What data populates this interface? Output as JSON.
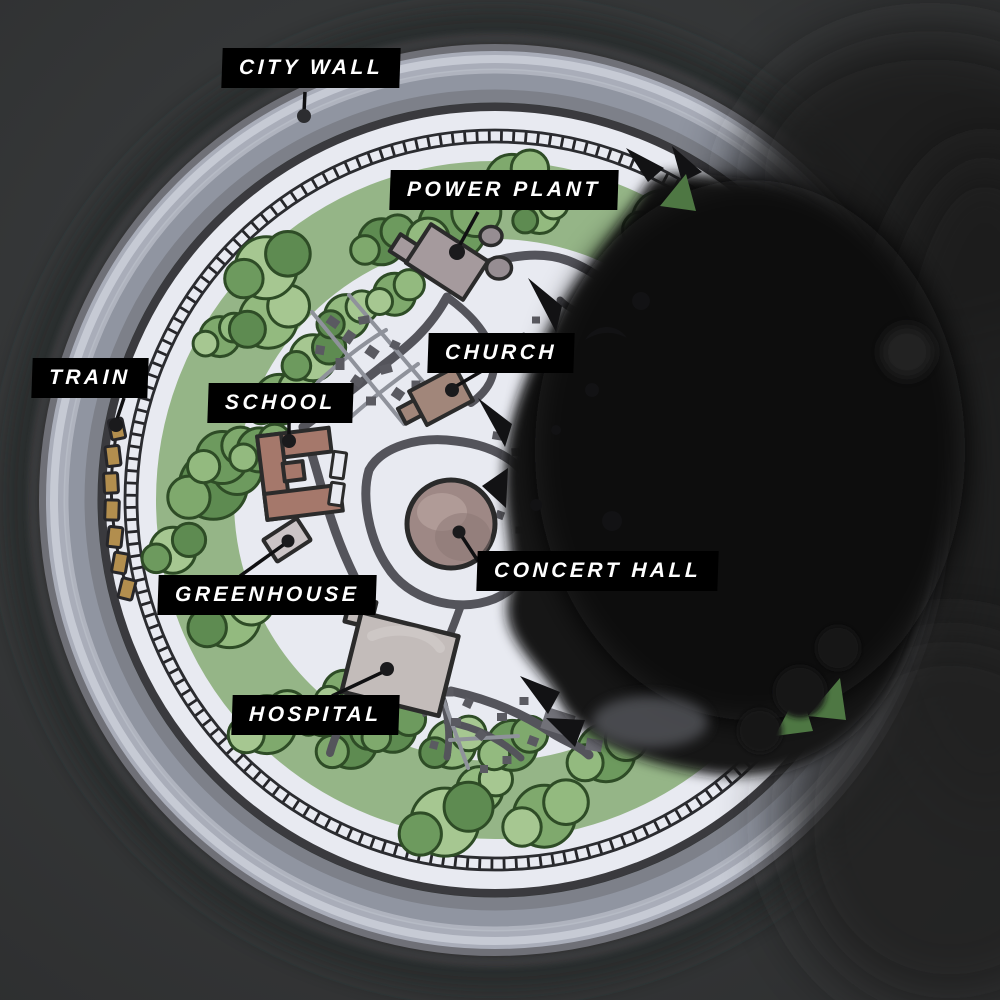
{
  "map": {
    "type": "illustrated-walled-city-map",
    "labels": {
      "city_wall": {
        "text": "CITY WALL"
      },
      "power_plant": {
        "text": "POWER PLANT"
      },
      "church": {
        "text": "CHURCH"
      },
      "train": {
        "text": "TRAIN"
      },
      "school": {
        "text": "SCHOOL"
      },
      "greenhouse": {
        "text": "GREENHOUSE"
      },
      "concert_hall": {
        "text": "CONCERT HALL"
      },
      "hospital": {
        "text": "HOSPITAL"
      }
    },
    "colors": {
      "background": "#343637",
      "label_bg": "#000000",
      "label_text": "#ffffff",
      "wall": "#a9adb9",
      "ground": "#e8eaf1",
      "forest_base": "#86ab74",
      "road": "#54545b",
      "ink_blot": "#141416",
      "train_car": "#b28e4e",
      "school_building": "#a5786b",
      "church_building": "#a1867a",
      "hospital_building": "#c3bcba",
      "concert_hall_building": "#9e8885",
      "power_plant_building": "#a59a9d",
      "greenhouse_building": "#cbc4c6"
    }
  }
}
